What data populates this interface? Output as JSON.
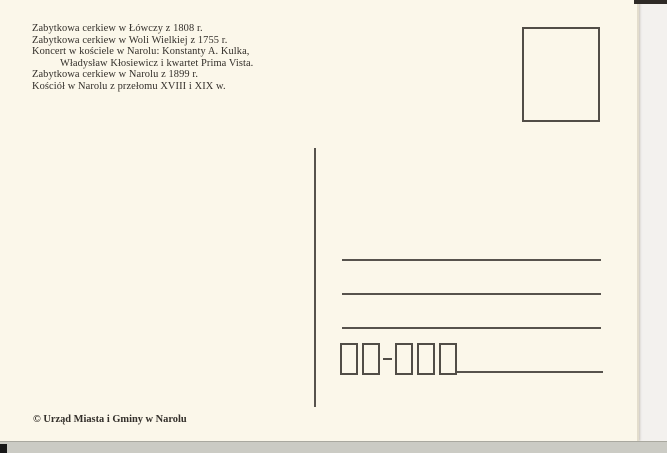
{
  "captions": {
    "lines": [
      "Zabytkowa cerkiew w Łówczy z 1808 r.",
      "Zabytkowa cerkiew w Woli Wielkiej z 1755 r.",
      "Koncert w kościele w Narolu: Konstanty A. Kulka,",
      "Władysław Kłosiewicz i kwartet Prima Vista.",
      "Zabytkowa cerkiew w Narolu z 1899 r.",
      "Kościół w Narolu z przełomu XVIII i XIX w."
    ]
  },
  "postal_code": {
    "separator_glyph": "-",
    "group_sizes": [
      2,
      3
    ]
  },
  "address": {
    "blank_line_count": 3
  },
  "publisher": {
    "copyright": "© Urząd Miasta i Gminy w Narolu"
  },
  "colors": {
    "card_background": "#fbf7ea",
    "ink": "#514d47",
    "text": "#332f2a",
    "scanner_right": "#f3f1ee",
    "scanner_bottom": "#cbcbc4"
  }
}
